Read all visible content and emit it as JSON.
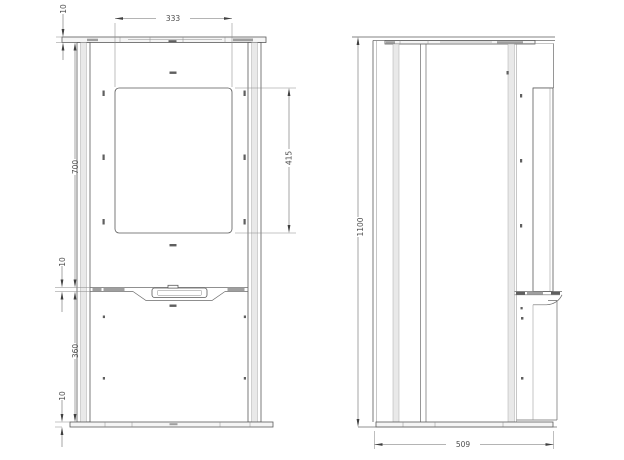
{
  "colors": {
    "background": "#ffffff",
    "line": "#5a5a5a",
    "dimension_text": "#4d4d4d"
  },
  "front_view": {
    "dims": {
      "top_thickness": "10",
      "opening_width": "333",
      "upper_section_height": "700",
      "opening_height": "415",
      "divider_gap": "10",
      "lower_section_height": "360",
      "base_thickness": "10"
    }
  },
  "side_view": {
    "dims": {
      "overall_height": "1100",
      "overall_depth": "509"
    }
  }
}
